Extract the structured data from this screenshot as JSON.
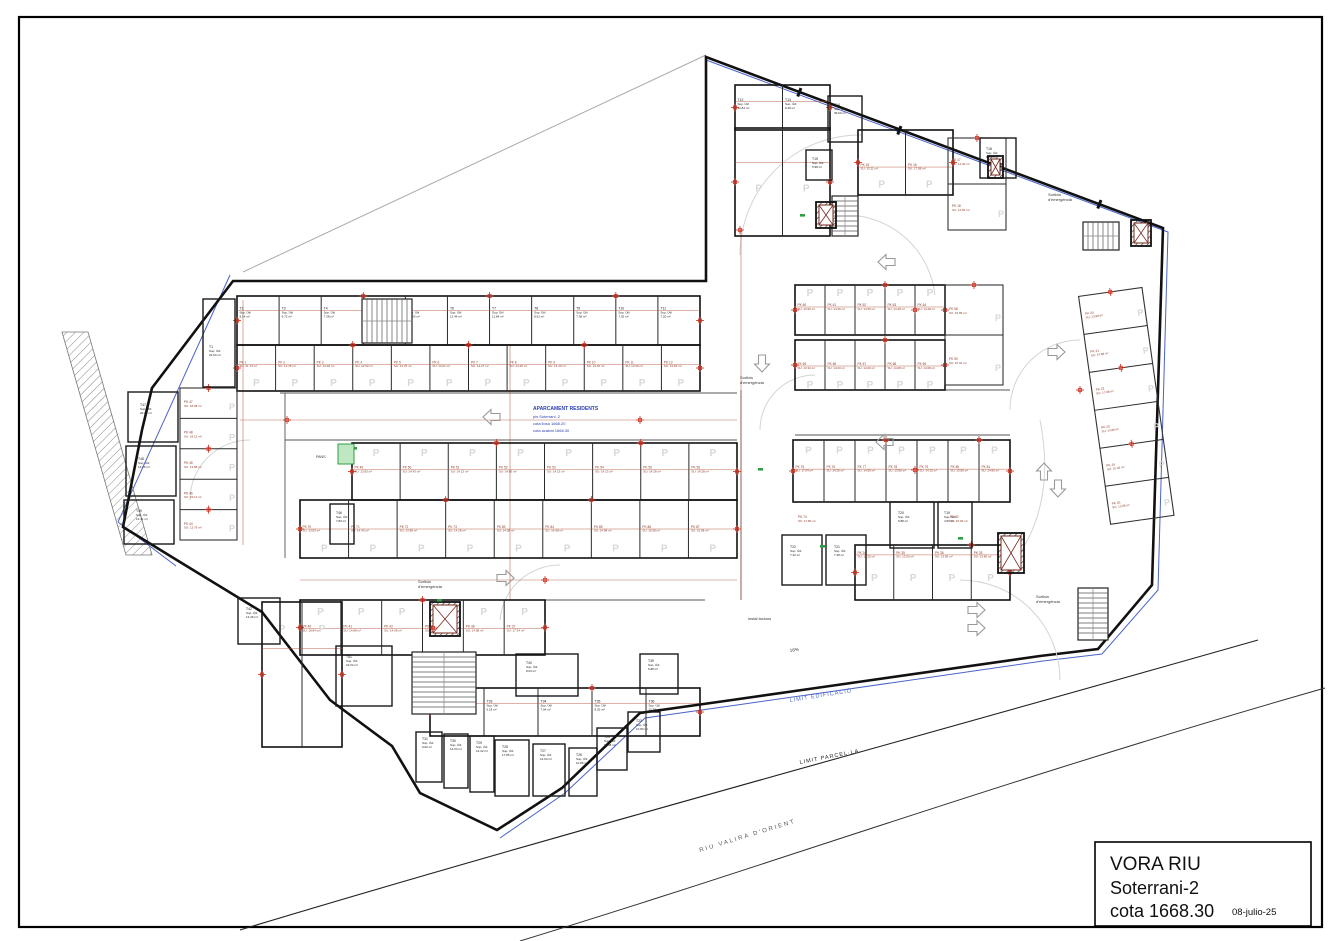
{
  "title_block": {
    "project": "VORA RIU",
    "level": "Soterrani-2",
    "cota": "cota 1668.30",
    "date": "08-julio-25"
  },
  "center_annotation": {
    "line1": "APARCAMENT RESIDENTS",
    "line2": "pis Soterrani -2",
    "line3": "cota llosa 1668.20",
    "line4": "cota acabat 1668.30"
  },
  "site_labels": {
    "riu": "RIU VALIRA D'ORIENT",
    "parcella": "LIMIT PARCEL·LA",
    "edificacio": "LIMIT EDIFICACIÓ"
  },
  "annotations": {
    "exit1": "Sortida",
    "exit2": "d'emergència",
    "installations": "instal·lacions",
    "slope": "16%",
    "pans": "PANS"
  },
  "labels": {
    "sup": "Sup. Útil",
    "su_prefix": "SU:",
    "unit": "m²",
    "p": "P"
  },
  "colors": {
    "wall": "#111111",
    "pk_text": "#8b3a2a",
    "cross": "#cc2a1a",
    "dim": "#b5543b",
    "blue_note": "#2a3fb0",
    "limit_blue": "#4a63c8",
    "green": "#2f9e44",
    "watermark": "#d8d8d8"
  },
  "stall_rows": {
    "t_top": [
      "T2|9.14",
      "T3|6.72",
      "T4|7.38",
      "",
      "T5|13.20",
      "T6|12.44",
      "T7|11.84",
      "T8|8.61",
      "T9|7.38",
      "T10|7.02",
      "T11|7.20"
    ],
    "t_wing": [
      "T12|12.84",
      "T13|9.49"
    ],
    "t_b1": [
      "T32|7.73",
      "T33|6.18",
      "T34|7.04",
      "T35|8.02",
      "T36|12.76"
    ],
    "tl": [
      "PK 1|21.73",
      "PK 2|13.78",
      "PK 3|13.28",
      "PK 4|12.63",
      "PK 5|13.75",
      "PK 6|14.61",
      "PK 7|14.27",
      "PK 8|13.25",
      "PK 9|13.40",
      "PK 10|13.40",
      "PK 11|13.60",
      "PK 12|13.60"
    ],
    "mid_top": [
      "PK 49|13.83",
      "PK 50|14.43",
      "PK 51|14.13",
      "PK 52|14.80",
      "PK 53|14.13",
      "PK 54|14.13",
      "PK 55|14.28",
      "PK 56|14.28"
    ],
    "mid_bot": [
      "PK 70|13.83",
      "PK 71|14.43",
      "PK 72|13.88",
      "PK 73|14.28",
      "PK 83|14.08",
      "PK 84|14.98",
      "PK 85|14.98",
      "PK 86|15.08",
      "PK 87|15.08"
    ],
    "tr_top": [
      "PK 60|13.50",
      "PK 61|14.25",
      "PK 62|14.50",
      "PK 63|14.28",
      "PK 64|14.28"
    ],
    "tr_bot": [
      "PK 65|13.34",
      "PK 66|14.00",
      "PK 67|14.00",
      "PK 68|14.08",
      "PK 69|14.08"
    ],
    "tr_right": [
      "PK 58|15.86",
      "PK 59|15.02"
    ],
    "mr_top": [
      "PK 75|17.04",
      "PK 76|14.26",
      "PK 77|14.50",
      "PK 78|13.80",
      "PK 79|14.15",
      "PK 80|13.80",
      "PK 81|14.83"
    ],
    "mr_bot": [
      "PK 34|13.25",
      "PK 35|13.00",
      "PK 36|13.85",
      "PK 33|13.80"
    ],
    "right_edge": [
      "PK 20|13.88",
      "PK 21|14.88",
      "PK 22|17.88",
      "PK 23|14.88",
      "PK 24|15.48",
      "PK 25|13.88"
    ],
    "b1": [
      "PK 40|18.84",
      "PK 41|14.88",
      "PK 42|14.08",
      "PK 39|16.04",
      "PK 38|14.88",
      "PK 37|17.34"
    ],
    "left_col": [
      "PK 47|18.08",
      "PK 48|18.12",
      "PK 45|13.88",
      "PK 46|15.11",
      "PK 44|13.79"
    ],
    "tr2": [
      "PK 15|13.11",
      "PK 16|17.08"
    ],
    "tr2b": [
      "PK 17|14.30",
      "PK 18|14.50"
    ],
    "wing": [
      "",
      ""
    ],
    "bl_col": [
      "",
      ""
    ]
  },
  "pk_singles": [
    {
      "id": "PK 74",
      "area": "17.80",
      "x": 798,
      "y": 518
    },
    {
      "id": "PK 82",
      "area": "15.06",
      "x": 950,
      "y": 518
    }
  ],
  "rooms": [
    {
      "id": "T1",
      "area": "23.64",
      "x": 209,
      "y": 348,
      "rx": 203,
      "ry": 299,
      "rw": 32,
      "rh": 88
    },
    {
      "id": "T14",
      "area": "39.60",
      "x": 834,
      "y": 106,
      "rx": 828,
      "ry": 96,
      "rw": 34,
      "rh": 46
    },
    {
      "id": "T15",
      "area": "5.98",
      "x": 812,
      "y": 160,
      "rx": 806,
      "ry": 150,
      "rw": 26,
      "rh": 30
    },
    {
      "id": "T18",
      "area": "8.84",
      "x": 986,
      "y": 150,
      "rx": 980,
      "ry": 138,
      "rw": 36,
      "rh": 40
    },
    {
      "id": "T19",
      "area": "4.50",
      "x": 944,
      "y": 514,
      "rx": 938,
      "ry": 502,
      "rw": 34,
      "rh": 46
    },
    {
      "id": "T20",
      "area": "6.88",
      "x": 898,
      "y": 514,
      "rx": 890,
      "ry": 502,
      "rw": 44,
      "rh": 46
    },
    {
      "id": "T21",
      "area": "7.48",
      "x": 834,
      "y": 548,
      "rx": 826,
      "ry": 535,
      "rw": 40,
      "rh": 50
    },
    {
      "id": "T22",
      "area": "7.32",
      "x": 790,
      "y": 548,
      "rx": 782,
      "ry": 535,
      "rw": 40,
      "rh": 50
    },
    {
      "id": "T23",
      "area": "10.80",
      "x": 636,
      "y": 722,
      "rx": 628,
      "ry": 712,
      "rw": 32,
      "rh": 40
    },
    {
      "id": "T24",
      "area": "11.88",
      "x": 604,
      "y": 738,
      "rx": 597,
      "ry": 728,
      "rw": 30,
      "rh": 42
    },
    {
      "id": "T26",
      "area": "10.86",
      "x": 576,
      "y": 756,
      "rx": 569,
      "ry": 748,
      "rw": 28,
      "rh": 48
    },
    {
      "id": "T27",
      "area": "14.04",
      "x": 540,
      "y": 752,
      "rx": 533,
      "ry": 744,
      "rw": 32,
      "rh": 52
    },
    {
      "id": "T28",
      "area": "17.85",
      "x": 502,
      "y": 748,
      "rx": 495,
      "ry": 740,
      "rw": 34,
      "rh": 56
    },
    {
      "id": "T29",
      "area": "14.32",
      "x": 476,
      "y": 744,
      "rx": 470,
      "ry": 736,
      "rw": 24,
      "rh": 56
    },
    {
      "id": "T30",
      "area": "14.33",
      "x": 450,
      "y": 742,
      "rx": 444,
      "ry": 734,
      "rw": 24,
      "rh": 54
    },
    {
      "id": "T31",
      "area": "9.62",
      "x": 422,
      "y": 740,
      "rx": 416,
      "ry": 732,
      "rw": 26,
      "rh": 50
    },
    {
      "id": "T39",
      "area": "6.88",
      "x": 648,
      "y": 662,
      "rx": 640,
      "ry": 654,
      "rw": 38,
      "rh": 40
    },
    {
      "id": "T40",
      "area": "8.03",
      "x": 526,
      "y": 664,
      "rx": 516,
      "ry": 654,
      "rw": 62,
      "rh": 42
    },
    {
      "id": "T42",
      "area": "13.46",
      "x": 246,
      "y": 610,
      "rx": 238,
      "ry": 598,
      "rw": 42,
      "rh": 46
    },
    {
      "id": "T46",
      "area": "7.83",
      "x": 336,
      "y": 514,
      "rx": 330,
      "ry": 504,
      "rw": 24,
      "rh": 40
    },
    {
      "id": "T47",
      "area": "20.04",
      "x": 140,
      "y": 406,
      "rx": 128,
      "ry": 392,
      "rw": 50,
      "rh": 50
    },
    {
      "id": "T48",
      "area": "13.26",
      "x": 138,
      "y": 460,
      "rx": 126,
      "ry": 446,
      "rw": 50,
      "rh": 50
    },
    {
      "id": "T49",
      "area": "12.41",
      "x": 136,
      "y": 512,
      "rx": 124,
      "ry": 500,
      "rw": 50,
      "rh": 44
    },
    {
      "id": "T51",
      "area": "22.62",
      "x": 346,
      "y": 658,
      "rx": 336,
      "ry": 646,
      "rw": 56,
      "rh": 60
    }
  ]
}
